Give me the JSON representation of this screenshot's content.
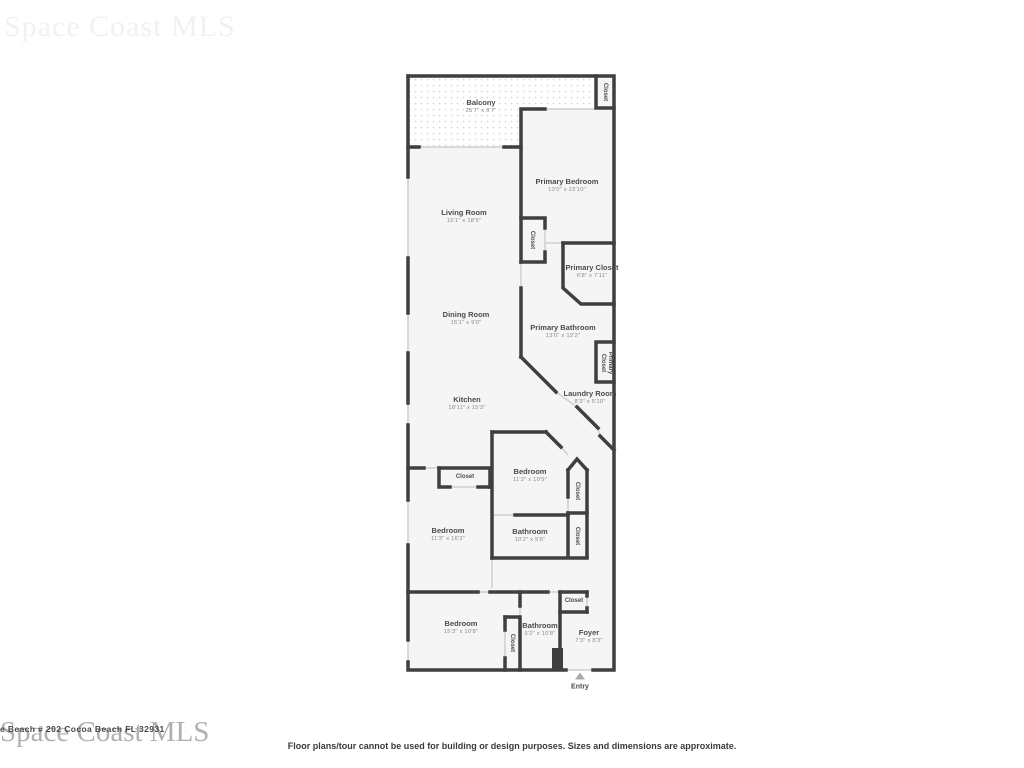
{
  "watermarks": {
    "top": "Space Coast MLS",
    "bottom": "Space Coast MLS",
    "listing_overlay": "e Beach # 202 Cocoa Beach FL 32931"
  },
  "disclaimer": "Floor plans/tour cannot be used for building or design purposes. Sizes and dimensions are approximate.",
  "entry": {
    "label": "Entry",
    "icon": "triangle-up-icon"
  },
  "rooms": {
    "balcony": {
      "name": "Balcony",
      "dims": "25'7\" x 9'7\""
    },
    "closet_balcony": {
      "name": "Closet"
    },
    "primary_bedroom": {
      "name": "Primary Bedroom",
      "dims": "13'0\" x 23'10\""
    },
    "living_room": {
      "name": "Living Room",
      "dims": "15'1\" x 18'5\""
    },
    "closet_primary_bedroom": {
      "name": "Closet"
    },
    "primary_closet": {
      "name": "Primary Closet",
      "dims": "6'8\" x 7'11\""
    },
    "dining_room": {
      "name": "Dining Room",
      "dims": "15'1\" x 9'0\""
    },
    "primary_bathroom": {
      "name": "Primary Bathroom",
      "dims": "13'0\" x 12'2\""
    },
    "primary_closet_small": {
      "name": "Primary Closet"
    },
    "laundry_room": {
      "name": "Laundry Room",
      "dims": "8'3\" x 5'10\""
    },
    "kitchen": {
      "name": "Kitchen",
      "dims": "18'11\" x 15'3\""
    },
    "closet_hall": {
      "name": "Closet"
    },
    "bedroom_2": {
      "name": "Bedroom",
      "dims": "11'2\" x 10'9\""
    },
    "closet_bedroom_2": {
      "name": "Closet"
    },
    "bedroom_3": {
      "name": "Bedroom",
      "dims": "11'3\" x 16'3\""
    },
    "bathroom_2": {
      "name": "Bathroom",
      "dims": "10'2\" x 5'6\""
    },
    "closet_bathroom_2": {
      "name": "Closet"
    },
    "closet_foyer": {
      "name": "Closet"
    },
    "bedroom_4": {
      "name": "Bedroom",
      "dims": "15'3\" x 10'8\""
    },
    "closet_bedroom_4": {
      "name": "Closet"
    },
    "bathroom_3": {
      "name": "Bathroom",
      "dims": "5'2\" x 10'8\""
    },
    "foyer": {
      "name": "Foyer",
      "dims": "7'3\" x 8'3\""
    }
  },
  "colors": {
    "wall": "#3f3f3f",
    "floor": "#f5f5f5",
    "opening": "#cfcfcf",
    "balcony_dots": "#d8d8d8"
  }
}
